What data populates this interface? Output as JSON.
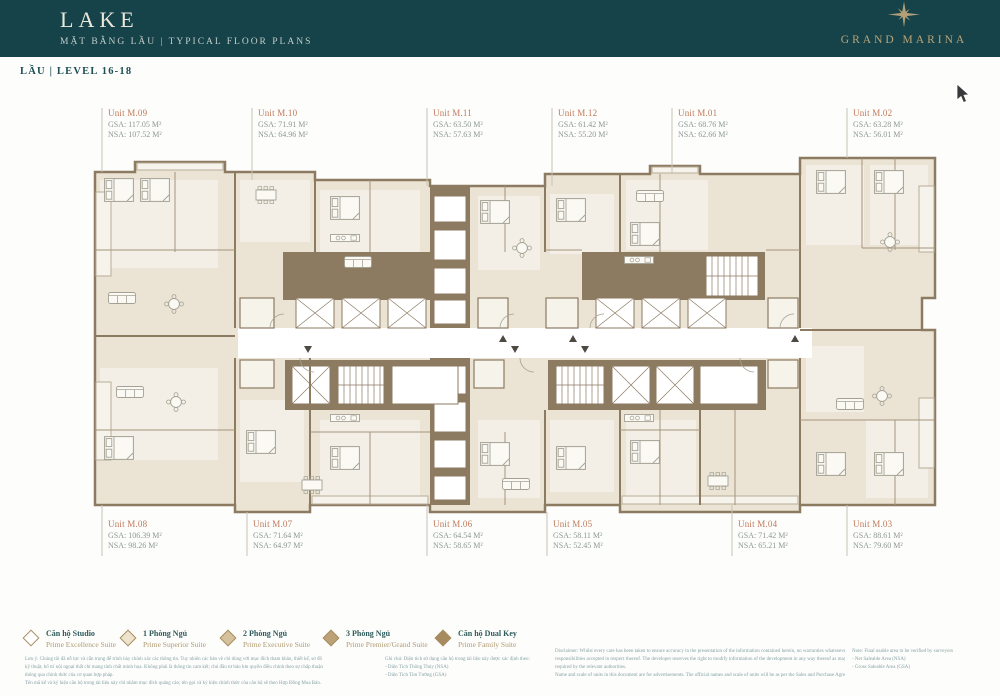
{
  "colors": {
    "header_bg": "#164349",
    "gold": "#b3a078",
    "teal_text": "#1d4f55",
    "unit_name_text": "#c0795a",
    "area_text": "#8d9894",
    "wall": "#8c7a61",
    "room_fill": "#ebe4d5",
    "room_light": "#f3efe6"
  },
  "header": {
    "title": "LAKE",
    "subtitle": "MẶT BẰNG LẦU  |  TYPICAL FLOOR PLANS",
    "brand": "GRAND MARINA"
  },
  "level_label": "LẦU | LEVEL 16-18",
  "units_top": [
    {
      "name": "Unit M.09",
      "gsa": "GSA: 117.05 M²",
      "nsa": "NSA: 107.52 M²"
    },
    {
      "name": "Unit M.10",
      "gsa": "GSA: 71.91 M²",
      "nsa": "NSA: 64.96 M²"
    },
    {
      "name": "Unit M.11",
      "gsa": "GSA: 63.50 M²",
      "nsa": "NSA: 57.63 M²"
    },
    {
      "name": "Unit M.12",
      "gsa": "GSA: 61.42 M²",
      "nsa": "NSA: 55.20 M²"
    },
    {
      "name": "Unit M.01",
      "gsa": "GSA: 68.76 M²",
      "nsa": "NSA: 62.66 M²"
    },
    {
      "name": "Unit M.02",
      "gsa": "GSA: 63.28 M²",
      "nsa": "NSA: 56.01 M²"
    }
  ],
  "units_bottom": [
    {
      "name": "Unit M.08",
      "gsa": "GSA: 106.39 M²",
      "nsa": "NSA: 98.26 M²"
    },
    {
      "name": "Unit M.07",
      "gsa": "GSA: 71.64 M²",
      "nsa": "NSA: 64.97 M²"
    },
    {
      "name": "Unit M.06",
      "gsa": "GSA: 64.54 M²",
      "nsa": "NSA: 58.65 M²"
    },
    {
      "name": "Unit M.05",
      "gsa": "GSA: 58.11 M²",
      "nsa": "NSA: 52.45 M²"
    },
    {
      "name": "Unit M.04",
      "gsa": "GSA: 71.42 M²",
      "nsa": "NSA: 65.21 M²"
    },
    {
      "name": "Unit M.03",
      "gsa": "GSA: 88.61 M²",
      "nsa": "NSA: 79.60 M²"
    }
  ],
  "legend": {
    "items": [
      {
        "vi": "Căn hộ Studio",
        "en": "Prime Excellence Suite"
      },
      {
        "vi": "1 Phòng Ngủ",
        "en": "Prime Superior Suite"
      },
      {
        "vi": "2 Phòng Ngủ",
        "en": "Prime Executive Suite"
      },
      {
        "vi": "3 Phòng Ngủ",
        "en": "Prime Premier/Grand Suite"
      },
      {
        "vi": "Căn hộ Dual Key",
        "en": "Prime Family Suite"
      }
    ]
  },
  "fineprint": {
    "vi": [
      "Lưu ý: Chúng tôi đã nỗ lực và cẩn trọng để trình bày chính xác các thông tin. Tuy nhiên các bản vẽ chỉ dùng với mục đích tham khảo, thiết kế, sơ đồ",
      "kỹ thuật, bố trí nội ngoại thất chỉ mang tính chất minh họa. Không phải là thông tin cam kết; chủ đầu tư bảo lưu quyền điều chỉnh theo sự chấp thuận",
      "thông qua chính thức của cơ quan hợp pháp.",
      "Tên mã kế và ký hiệu căn hộ trong tài liệu này chỉ nhằm mục đích quảng cáo; tên gọi và ký hiệu chính thức của căn hộ sẽ theo Hợp Đồng Mua Bán."
    ],
    "ghichu": [
      "Ghi chú: Diện tích sử dụng căn hộ trong tài liệu này được xác định theo:",
      "- Diện Tích Thông Thủy (NSA)",
      "- Diện Tích Tim Tường (GSA)"
    ],
    "disclaimer": [
      "Disclaimer: Whilst every care has been taken to ensure accuracy in the presentation of the information contained herein, no warranties whatsoever are given or legal",
      "responsibilities accepted in respect thereof. The developer reserves the right to modify information of the development in any way thereof as maybe approved or",
      "required by the relevant authorities.",
      "Name and scale of units in this document are for advertisements. The official names and scale of units will be as per the Sales and Purchase Agreement."
    ],
    "note": [
      "Note: Final usable area to be verified by surveyors",
      "- Net Saleable Area (NSA)",
      "- Gross Saleable Area (GSA)"
    ]
  }
}
